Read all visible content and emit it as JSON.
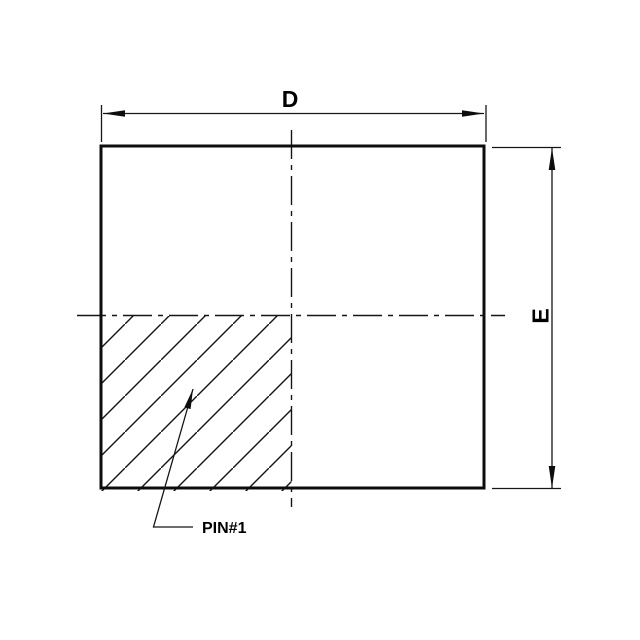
{
  "drawing": {
    "labels": {
      "horizontal_dimension": "D",
      "vertical_dimension": "E",
      "pin_one_callout": "PIN#1"
    },
    "colors": {
      "line": "#161616",
      "outline": "#0d0d0d",
      "background": "#ffffff"
    }
  }
}
